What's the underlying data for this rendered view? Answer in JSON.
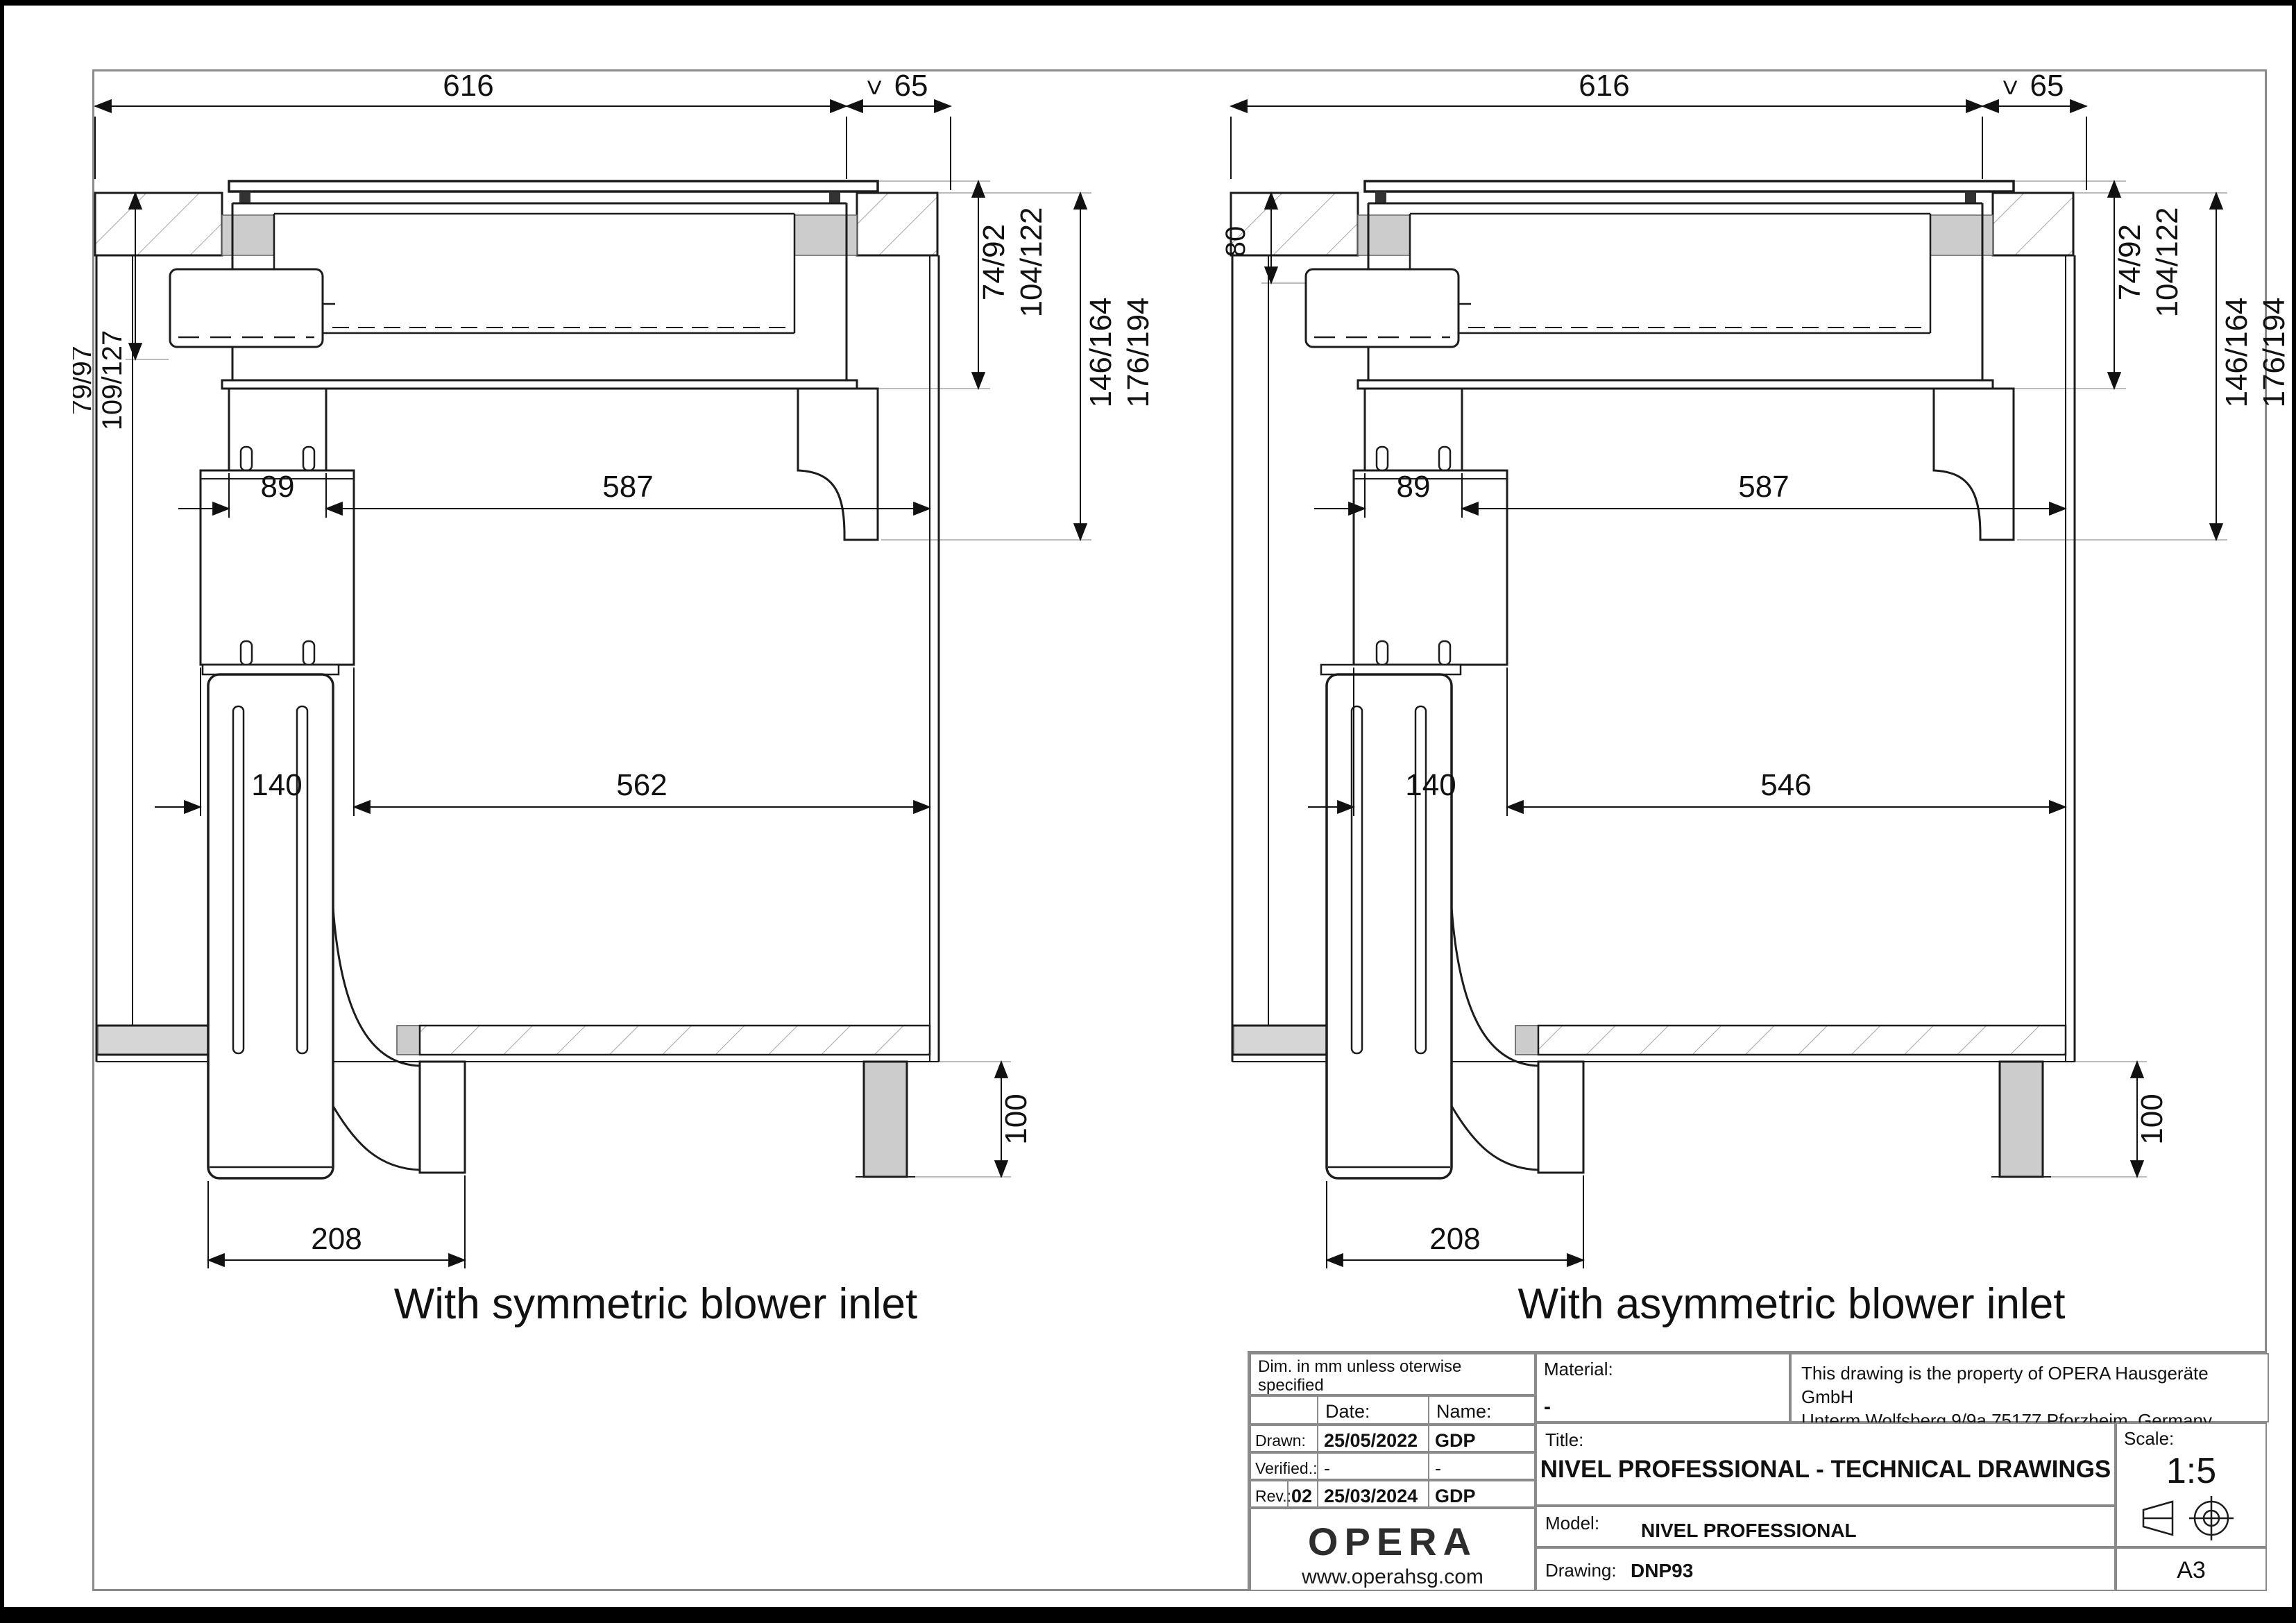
{
  "drawings": {
    "symmetric": {
      "caption": "With symmetric blower inlet",
      "dims": {
        "top_width": "616",
        "min_symbol": ">",
        "side_clearance": "65",
        "hob_depth_a": "74/92",
        "hob_depth_b": "104/122",
        "install_depth_a": "146/164",
        "install_depth_b": "176/194",
        "left_depth_a": "79/97",
        "left_depth_b": "109/127",
        "duct_width": "89",
        "clearance_upper": "587",
        "box_width": "140",
        "clearance_lower": "562",
        "blower_width": "208",
        "leg_height": "100"
      }
    },
    "asymmetric": {
      "caption": "With asymmetric blower inlet",
      "dims": {
        "top_width": "616",
        "min_symbol": ">",
        "side_clearance": "65",
        "hob_depth_a": "74/92",
        "hob_depth_b": "104/122",
        "install_depth_a": "146/164",
        "install_depth_b": "176/194",
        "left_depth": "80",
        "duct_width": "89",
        "clearance_upper": "587",
        "box_width": "140",
        "clearance_lower": "546",
        "blower_width": "208",
        "leg_height": "100"
      }
    }
  },
  "title_block": {
    "note_line1": "Dim. in mm unless oterwise specified",
    "note_line2": "Tolerances ISO 2768",
    "col_date": "Date:",
    "col_name": "Name:",
    "drawn_label": "Drawn:",
    "drawn_date": "25/05/2022",
    "drawn_name": "GDP",
    "verified_label": "Verified.:",
    "verified_date": "-",
    "verified_name": "-",
    "rev_label": "Rev.:",
    "rev_number": "02",
    "rev_date": "25/03/2024",
    "rev_name": "GDP",
    "logo": "OPERA",
    "website": "www.operahsg.com",
    "material_label": "Material:",
    "material_value": "-",
    "property_line1": "This drawing is the property of OPERA Hausgeräte GmbH",
    "property_line2": "Unterm Wolfsberg 9/9a 75177 Pforzheim, Germany",
    "title_label": "Title:",
    "title_value": "NIVEL PROFESSIONAL - TECHNICAL DRAWINGS",
    "scale_label": "Scale:",
    "scale_value": "1:5",
    "model_label": "Model:",
    "model_value": "NIVEL PROFESSIONAL",
    "drawing_label": "Drawing:",
    "drawing_value": "DNP93",
    "paper_size": "A3"
  }
}
